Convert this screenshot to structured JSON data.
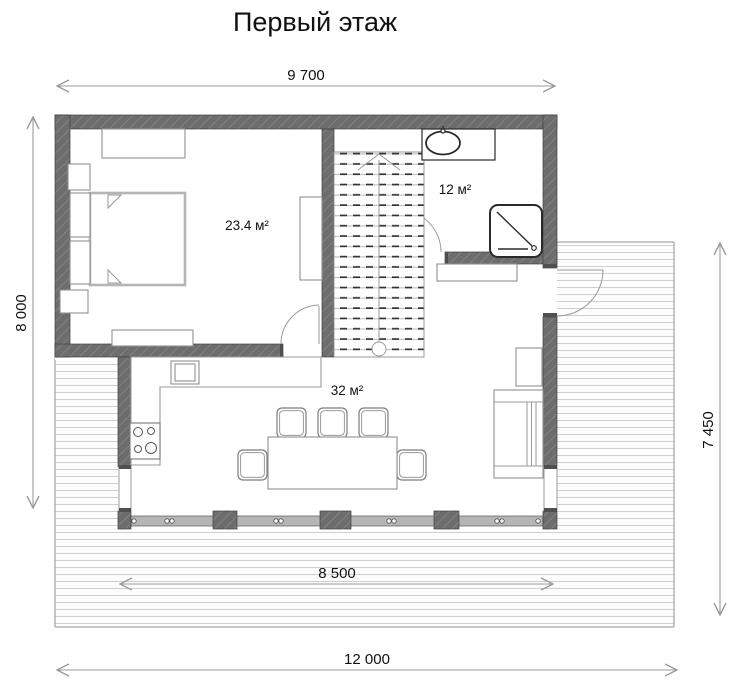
{
  "title": "Первый этаж",
  "dimensions": {
    "width_top": "9 700",
    "height_left": "8 000",
    "height_right": "7 450",
    "deck_width": "8 500",
    "total_width": "12 000"
  },
  "rooms": {
    "bedroom": {
      "area": "23.4 м²"
    },
    "bathroom": {
      "area": "12 м²"
    },
    "living_kitchen": {
      "area": "32 м²"
    }
  },
  "colors": {
    "wall": "#6d6d6d",
    "wall_hatch": "#828282",
    "dimension_line": "#9a9a9a",
    "text": "#111111",
    "furniture_stroke": "#909090",
    "fixture_stroke": "#2a2a2a",
    "deck_plank": "#cfcfcf",
    "glazing": "#b5b5b5"
  }
}
